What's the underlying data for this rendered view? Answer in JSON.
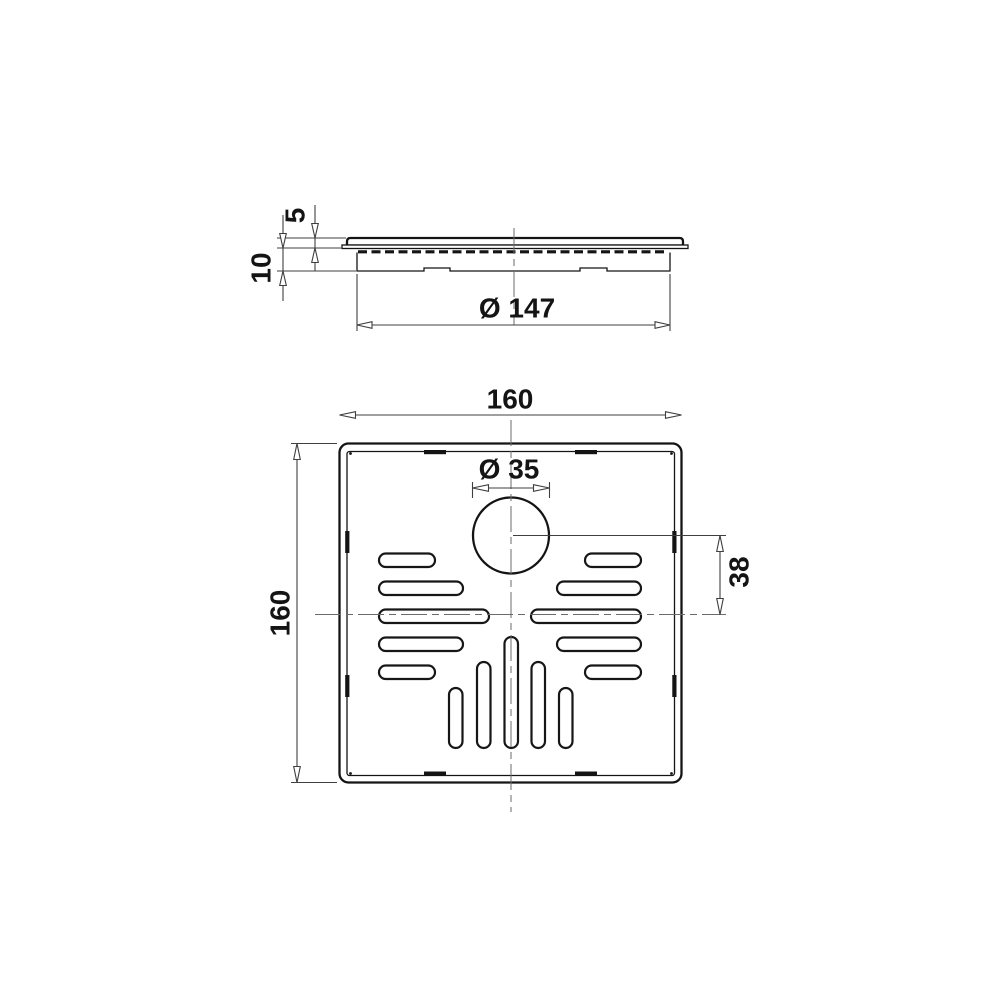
{
  "page": {
    "background": "#ffffff"
  },
  "drawing": {
    "kind": "two-view technical drawing of a square floor drain grate",
    "colors": {
      "outline": "#141414",
      "dimension": "#3f3f3f",
      "centerline": "#6b6b6b",
      "background": "#ffffff"
    },
    "side_view": {
      "dimensions": {
        "lid_thickness": "5",
        "body_depth": "10",
        "flange_diameter": "Ø 147"
      }
    },
    "plan_view": {
      "dimensions": {
        "outer_width": "160",
        "outer_height": "160",
        "outlet_diameter": "Ø 35",
        "outlet_offset": "38"
      }
    }
  }
}
